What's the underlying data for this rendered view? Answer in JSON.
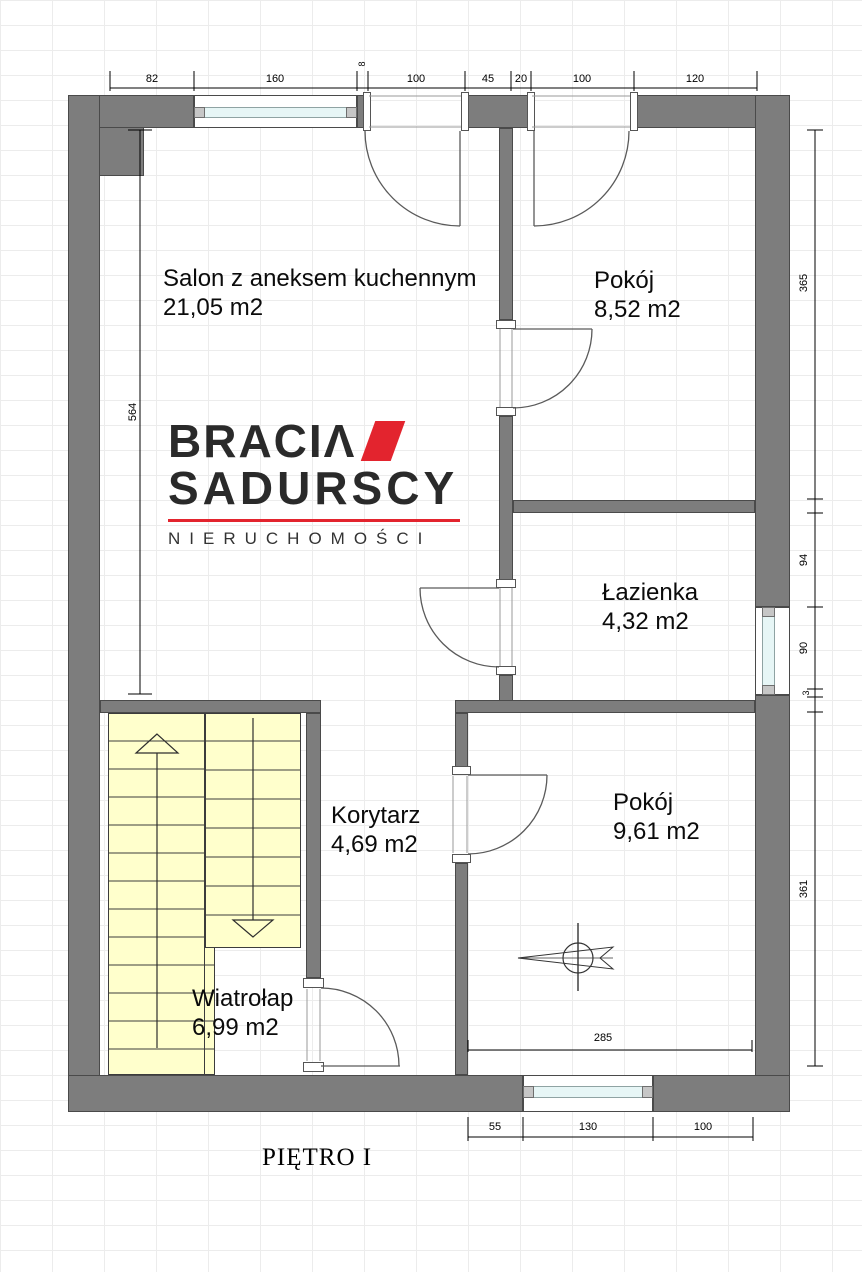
{
  "header": {
    "title": "PIĘTRO I"
  },
  "logo": {
    "brand_top": "BRACI",
    "brand_top_last": "Λ",
    "brand_bottom": "SADURSCY",
    "subtitle": "NIERUCHOMOŚCI",
    "accent_red": "#e3242e"
  },
  "rooms": {
    "salon": {
      "name": "Salon z aneksem kuchennym",
      "area": "21,05 m2"
    },
    "pokoj_gorny": {
      "name": "Pokój",
      "area": "8,52 m2"
    },
    "lazienka": {
      "name": "Łazienka",
      "area": "4,32 m2"
    },
    "korytarz": {
      "name": "Korytarz",
      "area": "4,69 m2"
    },
    "pokoj_dolny": {
      "name": "Pokój",
      "area": "9,61 m2"
    },
    "wiatrolap": {
      "name": "Wiatrołap",
      "area": "6,99 m2"
    }
  },
  "dimensions": {
    "top": [
      "82",
      "160",
      "8",
      "100",
      "45",
      "20",
      "100",
      "120"
    ],
    "left": [
      "564"
    ],
    "right": [
      "365",
      "94",
      "90",
      "3",
      "361"
    ],
    "bottom": [
      "55",
      "130",
      "100"
    ],
    "interior": [
      "285"
    ]
  },
  "colors": {
    "wall": "#7d7d7d",
    "stairs_fill": "#ffffcc",
    "window_glazing": "#e7f6f6",
    "logo_red": "#e3242e"
  }
}
